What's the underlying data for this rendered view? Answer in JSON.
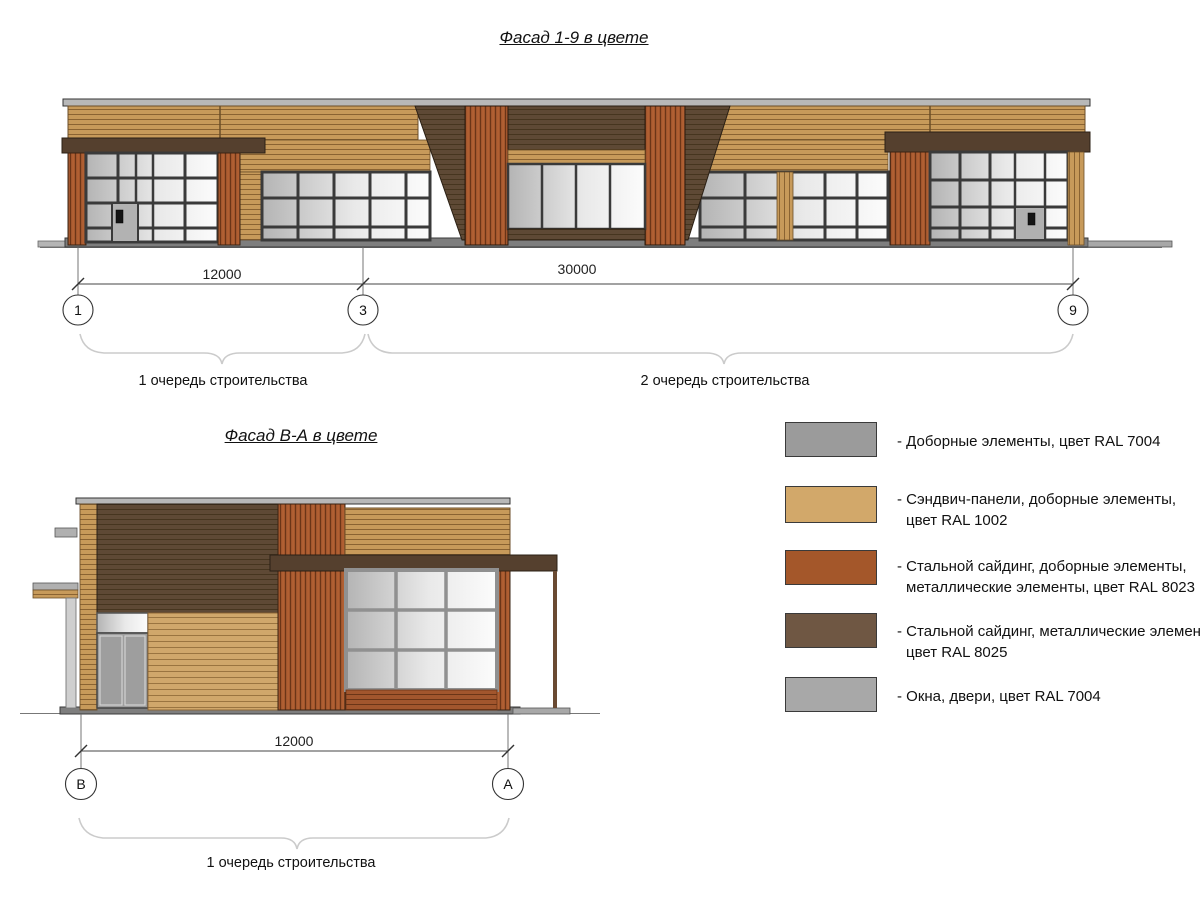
{
  "titles": {
    "facade19": "Фасад 1-9 в цвете",
    "facadeBA": "Фасад В-А в цвете"
  },
  "facade19": {
    "dimensions": [
      "12000",
      "30000"
    ],
    "axes": [
      "1",
      "3",
      "9"
    ],
    "phase_labels": [
      "1 очередь строительства",
      "2 очередь строительства"
    ]
  },
  "facadeBA": {
    "dimensions": [
      "12000"
    ],
    "axes": [
      "В",
      "А"
    ],
    "phase_labels": [
      "1 очередь строительства"
    ]
  },
  "legend": {
    "items": [
      {
        "swatch_color": "#9b9b9b",
        "lines": [
          "- Доборные элементы, цвет RAL 7004",
          ""
        ]
      },
      {
        "swatch_color": "#d2a86a",
        "lines": [
          "- Сэндвич-панели, доборные элементы,",
          "цвет RAL 1002"
        ]
      },
      {
        "swatch_color": "#a4572a",
        "lines": [
          "- Стальной сайдинг, доборные элементы,",
          "металлические элементы, цвет RAL 8023"
        ]
      },
      {
        "swatch_color": "#6f5743",
        "lines": [
          "- Стальной сайдинг, металлические элемен",
          "цвет RAL 8025"
        ]
      },
      {
        "swatch_color": "#a8a8a8",
        "lines": [
          "- Окна, двери, цвет RAL 7004",
          ""
        ]
      }
    ]
  },
  "colors": {
    "ral_7004_grey": "#9b9b9b",
    "ral_1002_sand_yellow": "#d0a76b",
    "ral_8023_orange_brown": "#a2562d",
    "ral_8025_pale_brown": "#5e4935",
    "glazing_grey": "#b6b6b6",
    "canopy_dark_brown": "#55402e"
  }
}
